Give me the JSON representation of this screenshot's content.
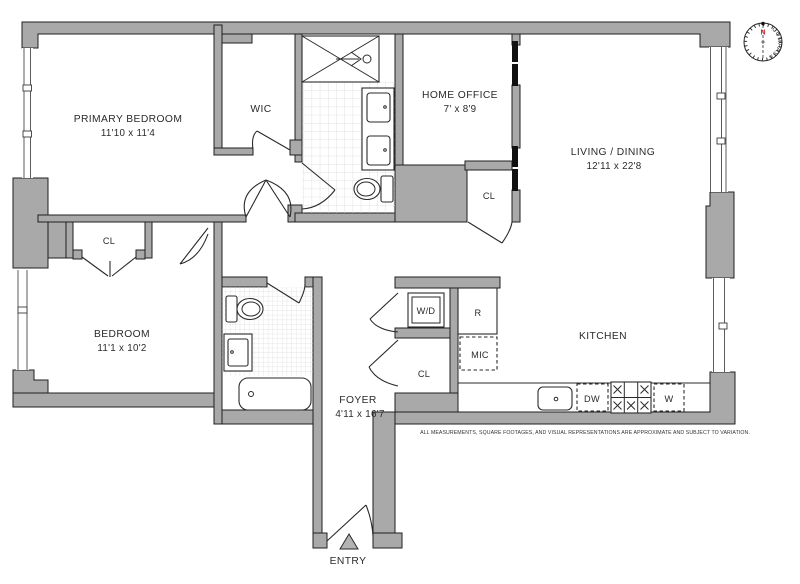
{
  "colors": {
    "wall_fill": "#a9a9a9",
    "wall_stroke": "#1f1f1f",
    "tile_line": "#d9d9d9",
    "north_red": "#c22222",
    "text": "#2b2b2b"
  },
  "rooms": {
    "primary_bedroom": {
      "name": "PRIMARY BEDROOM",
      "dims": "11'10 x 11'4"
    },
    "wic": {
      "name": "WIC"
    },
    "home_office": {
      "name": "HOME OFFICE",
      "dims": "7' x 8'9"
    },
    "living_dining": {
      "name": "LIVING / DINING",
      "dims": "12'11 x 22'8"
    },
    "bedroom": {
      "name": "BEDROOM",
      "dims": "11'1 x 10'2"
    },
    "kitchen": {
      "name": "KITCHEN"
    },
    "foyer": {
      "name": "FOYER",
      "dims": "4'11 x 16'7"
    }
  },
  "closets": {
    "primary_closet": "CL",
    "living_closet": "CL",
    "foyer_closet": "CL",
    "washer_dryer": "W/D"
  },
  "appliances": {
    "refrigerator": "R",
    "microwave": "MIC",
    "dishwasher": "DW",
    "washer": "W"
  },
  "entry": {
    "label": "ENTRY"
  },
  "compass": {
    "north": "N",
    "label": "COMPASS"
  },
  "disclaimer": "ALL MEASUREMENTS, SQUARE FOOTAGES, AND VISUAL REPRESENTATIONS ARE APPROXIMATE AND SUBJECT TO VARIATION."
}
